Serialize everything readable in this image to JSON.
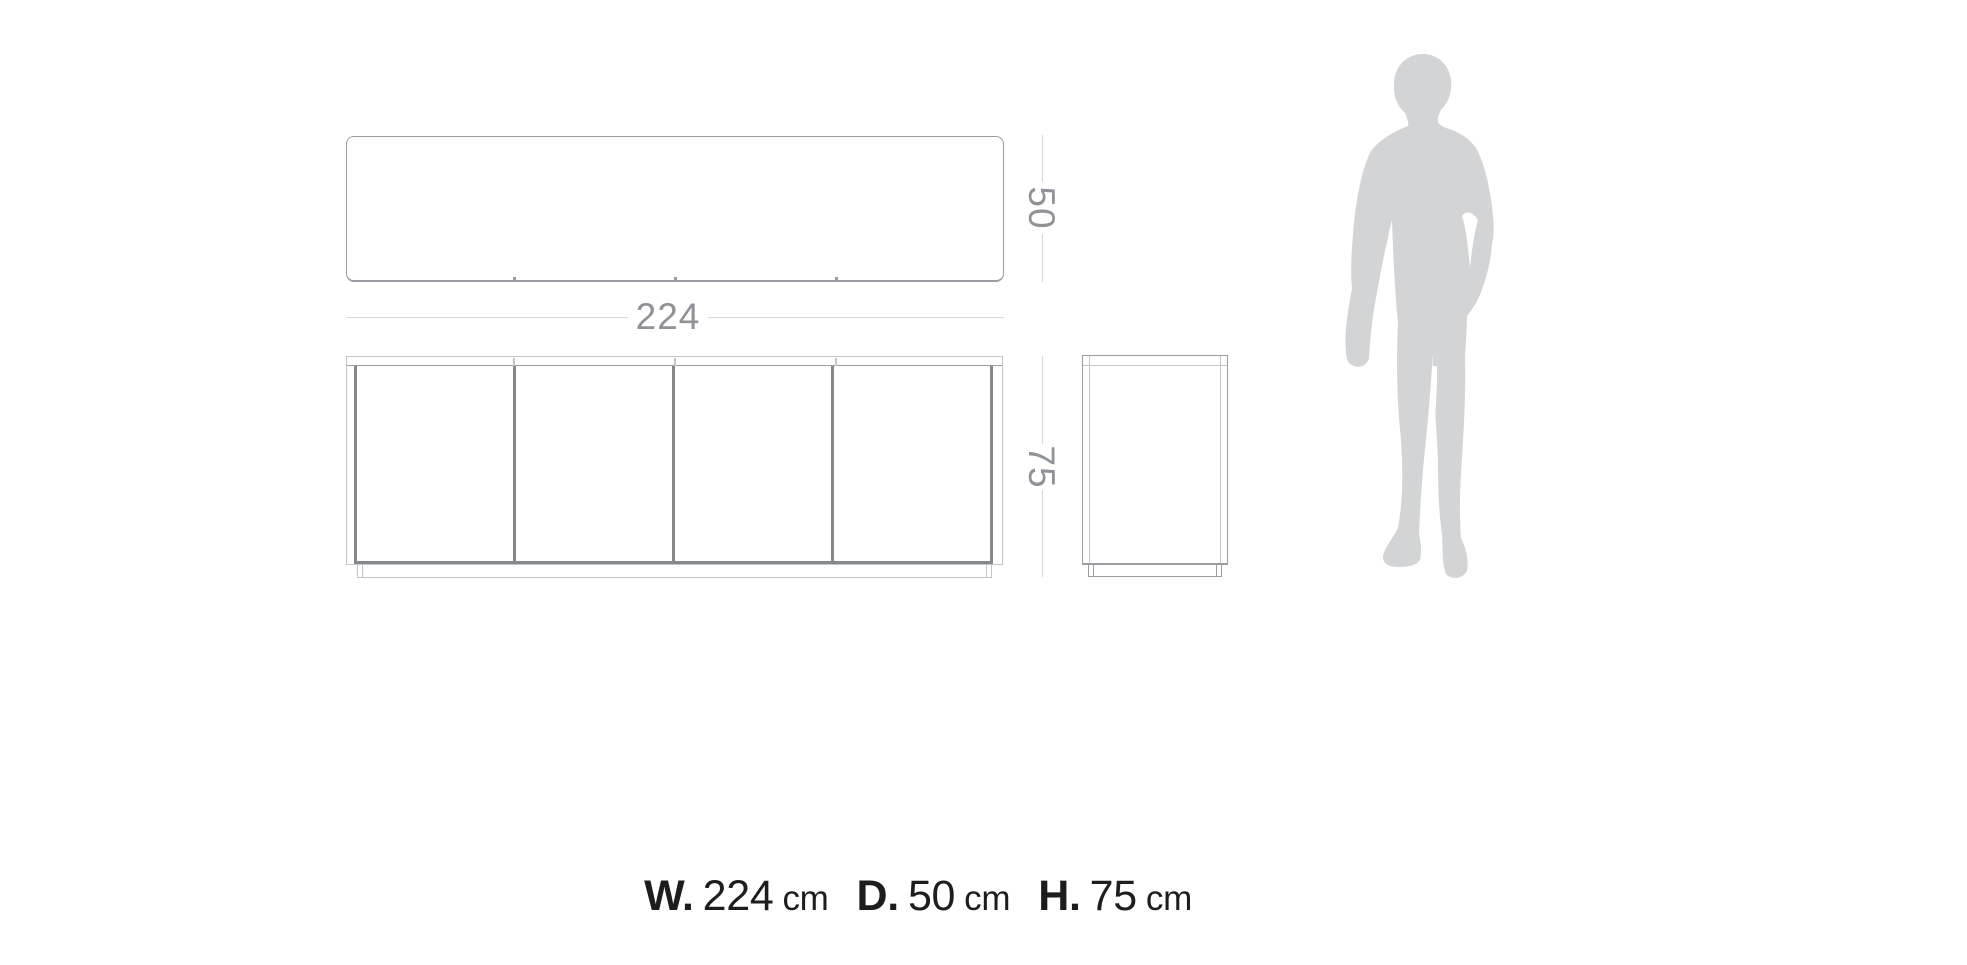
{
  "colors": {
    "background": "#ffffff",
    "line-light": "#c3c6c9",
    "line-medium": "#9a9ea2",
    "line-dark": "#85888b",
    "dim-line": "#d8d9da",
    "dim-text": "#8f9296",
    "caption-text": "#1d1d1f",
    "figure-fill": "#d2d4d5"
  },
  "dimensions": {
    "width_label": "224",
    "depth_label": "50",
    "height_label": "75"
  },
  "drawing": {
    "type": "furniture-dimension-diagram",
    "views": [
      "top-plan",
      "front-elevation",
      "side-elevation"
    ],
    "door_count": 4,
    "scale_figure": "standing man silhouette"
  },
  "caption": {
    "items": [
      {
        "label": "W.",
        "value": "224",
        "unit": "cm"
      },
      {
        "label": "D.",
        "value": "50",
        "unit": "cm"
      },
      {
        "label": "H.",
        "value": "75",
        "unit": "cm"
      }
    ]
  }
}
